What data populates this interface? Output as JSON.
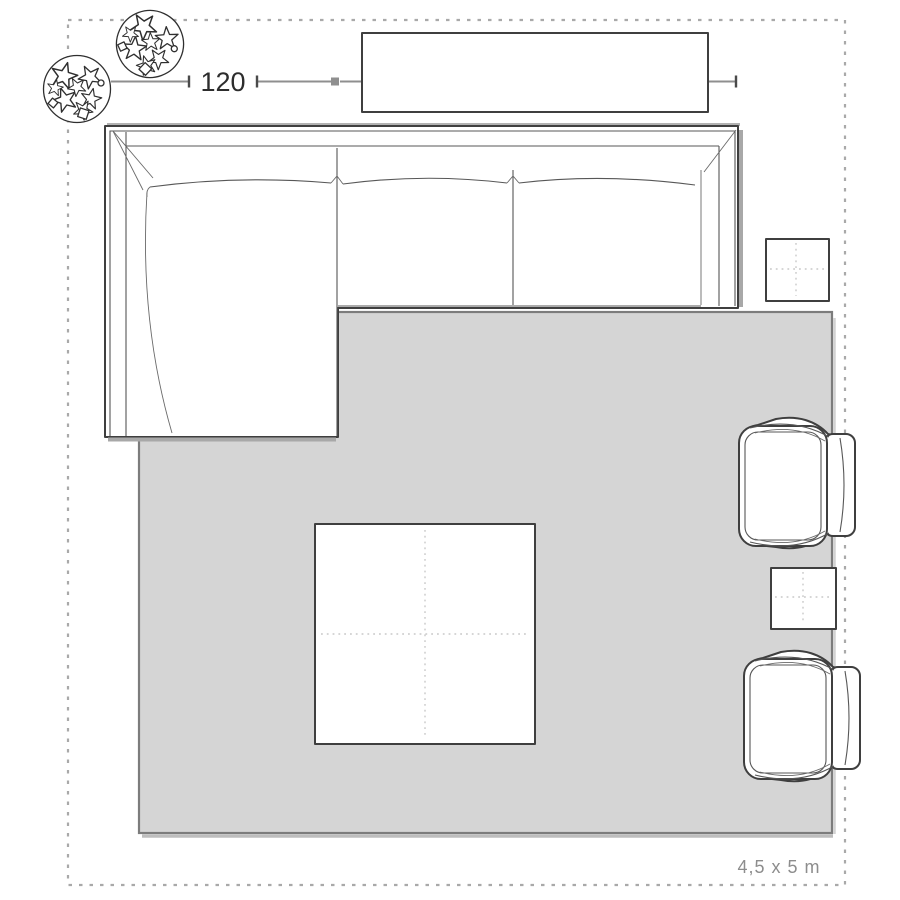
{
  "floorplan": {
    "dimension_labels": {
      "left": "120",
      "right": "233"
    },
    "room_size_label": "4,5 x 5 m",
    "colors": {
      "background": "#ffffff",
      "rug_fill": "#d5d5d5",
      "rug_border": "#7c7c7c",
      "furniture_outline": "#3f3f3f",
      "detail_line": "#575757",
      "dimension_line": "#8f8f8f",
      "dimension_text": "#2d2d2d",
      "dashed_border": "#a9a9a9",
      "shadow": "#a8a8a8",
      "dotted_centerline": "#c9c9c9",
      "room_label_text": "#8d8d8d"
    },
    "furniture": [
      {
        "name": "corner-sofa-with-chaise"
      },
      {
        "name": "sideboard"
      },
      {
        "name": "rug"
      },
      {
        "name": "coffee-table"
      },
      {
        "name": "side-table-top"
      },
      {
        "name": "side-table-bottom"
      },
      {
        "name": "armchair-top"
      },
      {
        "name": "armchair-bottom"
      },
      {
        "name": "plant-left"
      },
      {
        "name": "plant-top"
      }
    ]
  }
}
